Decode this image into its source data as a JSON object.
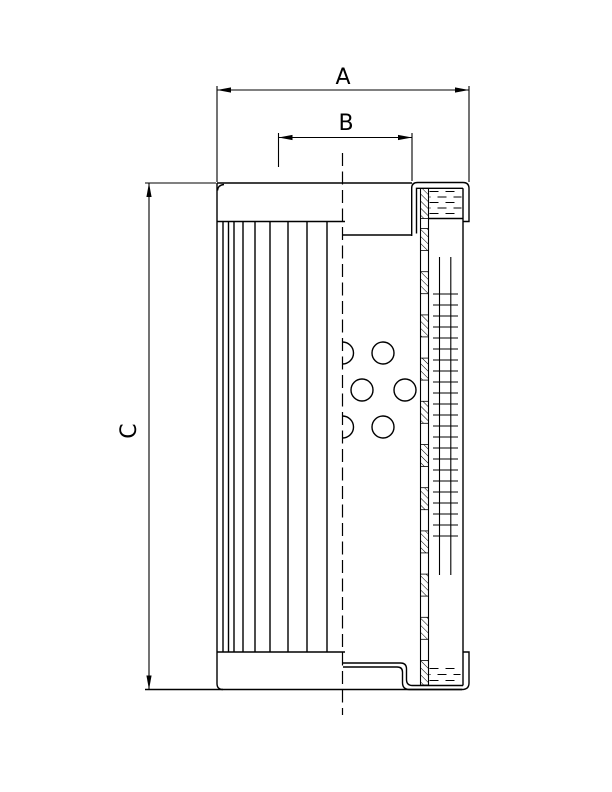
{
  "page": {
    "width": 612,
    "height": 792,
    "background": "#ffffff",
    "ink": "#000000"
  },
  "diagram": {
    "type": "technical-drawing",
    "subject": "cylindrical filter element, half-section side view",
    "labels": {
      "dim_a": "A",
      "dim_b": "B",
      "dim_c": "C"
    },
    "dimensions": [
      {
        "id": "A",
        "label": "A",
        "orientation": "horizontal",
        "extent": "full outer width across top end flange"
      },
      {
        "id": "B",
        "label": "B",
        "orientation": "horizontal",
        "extent": "inner cap opening width"
      },
      {
        "id": "C",
        "label": "C",
        "orientation": "vertical",
        "extent": "overall element height"
      }
    ],
    "features": [
      "pleated-filter-media",
      "perforated-core-tube",
      "support-wire-mesh",
      "top-end-cap",
      "bottom-end-cap",
      "gasket-seal-top",
      "gasket-seal-bottom",
      "centerline"
    ]
  },
  "geometry": {
    "canvas": {
      "w": 612,
      "h": 792
    },
    "stroke": {
      "main": 1.4,
      "thin": 1.1,
      "hatch": 0.9
    },
    "outline_paths": [
      "M 217,183 H 412",
      "M 217,183 V 683.5 Q 217,689.5 223,689.5",
      "M 217.5,190.5 Q 218,185 224,184.5",
      "M 217,221.5 H 345",
      "M 217,652 H 345",
      "M 145,689.5 H 462",
      "M 343,235 H 411.7",
      "M 411.7,236 V 188 Q 411.7,182.5 417.7,182.5 H 463 Q 469,182.5 469,188.5 V 221.5 H 463",
      "M 416.5,233.5 V 188.3 H 463",
      "M 463,188.3 V 685.5",
      "M 428.5,218.5 H 463",
      "M 343,663 H 400.5 Q 406.5,663 406.5,669 V 679.5 Q 406.5,685.5 412.5,685.5 H 463",
      "M 343,667 H 397 Q 402.5,667 402.5,672 V 682.5 Q 402.5,689.5 409.5,689.5 H 462 Q 469,689.5 469,683 V 652 H 463"
    ],
    "pleats": {
      "x": [
        223,
        228.5,
        234,
        243,
        255,
        270,
        288,
        307,
        327
      ],
      "y1": 221.5,
      "y2": 652
    },
    "core_strip": {
      "x1": 420.5,
      "x2": 428.5,
      "y1": 188.3,
      "y2": 685.5,
      "hatch_segments": [
        [
          188.5,
          218.5
        ],
        [
          228.5,
          250.5
        ],
        [
          271.7,
          293.7
        ],
        [
          314.9,
          336.9
        ],
        [
          358.1,
          380.1
        ],
        [
          401.3,
          423.3
        ],
        [
          444.5,
          466.5
        ],
        [
          487.7,
          509.7
        ],
        [
          530.9,
          552.9
        ],
        [
          574.1,
          596.1
        ],
        [
          617.3,
          639.3
        ],
        [
          660.5,
          685
        ]
      ]
    },
    "mesh": {
      "lines_x": [
        439.5,
        450.8
      ],
      "y1": 257,
      "y2": 575,
      "ticks": {
        "x1": 433,
        "x2": 458,
        "y_start": 294,
        "step": 11,
        "count": 23
      }
    },
    "holes": {
      "r": 11,
      "full": [
        [
          383,
          353
        ],
        [
          362,
          390
        ],
        [
          405,
          390
        ],
        [
          383,
          427
        ]
      ],
      "half": [
        [
          342.5,
          353
        ],
        [
          342.5,
          427
        ]
      ]
    },
    "gaskets": [
      {
        "x1": 429.5,
        "x2": 461.5,
        "rows": [
          191.5,
          197,
          202.5,
          208,
          213.5
        ]
      },
      {
        "x1": 429.5,
        "x2": 460.5,
        "rows": [
          668.5,
          674.5,
          680.5
        ]
      }
    ],
    "centerline": {
      "x": 342.5,
      "y1": 153,
      "y2": 715,
      "dash": "13 5.5"
    },
    "dims": {
      "A": {
        "y": 90,
        "x1": 217,
        "x2": 469,
        "ext": [
          [
            217,
            86,
            217,
            182
          ],
          [
            469,
            86,
            469,
            182
          ]
        ],
        "label_xy": [
          343,
          84
        ]
      },
      "B": {
        "y": 137.5,
        "x1": 278.5,
        "x2": 412,
        "ext": [
          [
            278.5,
            133,
            278.5,
            167
          ],
          [
            412,
            133,
            412,
            181
          ]
        ],
        "label_xy": [
          346,
          130
        ]
      },
      "C": {
        "x": 149,
        "y1": 183,
        "y2": 689.5,
        "ext": [
          [
            145,
            183,
            216,
            183
          ]
        ],
        "label_xy": [
          130,
          431
        ]
      }
    }
  }
}
